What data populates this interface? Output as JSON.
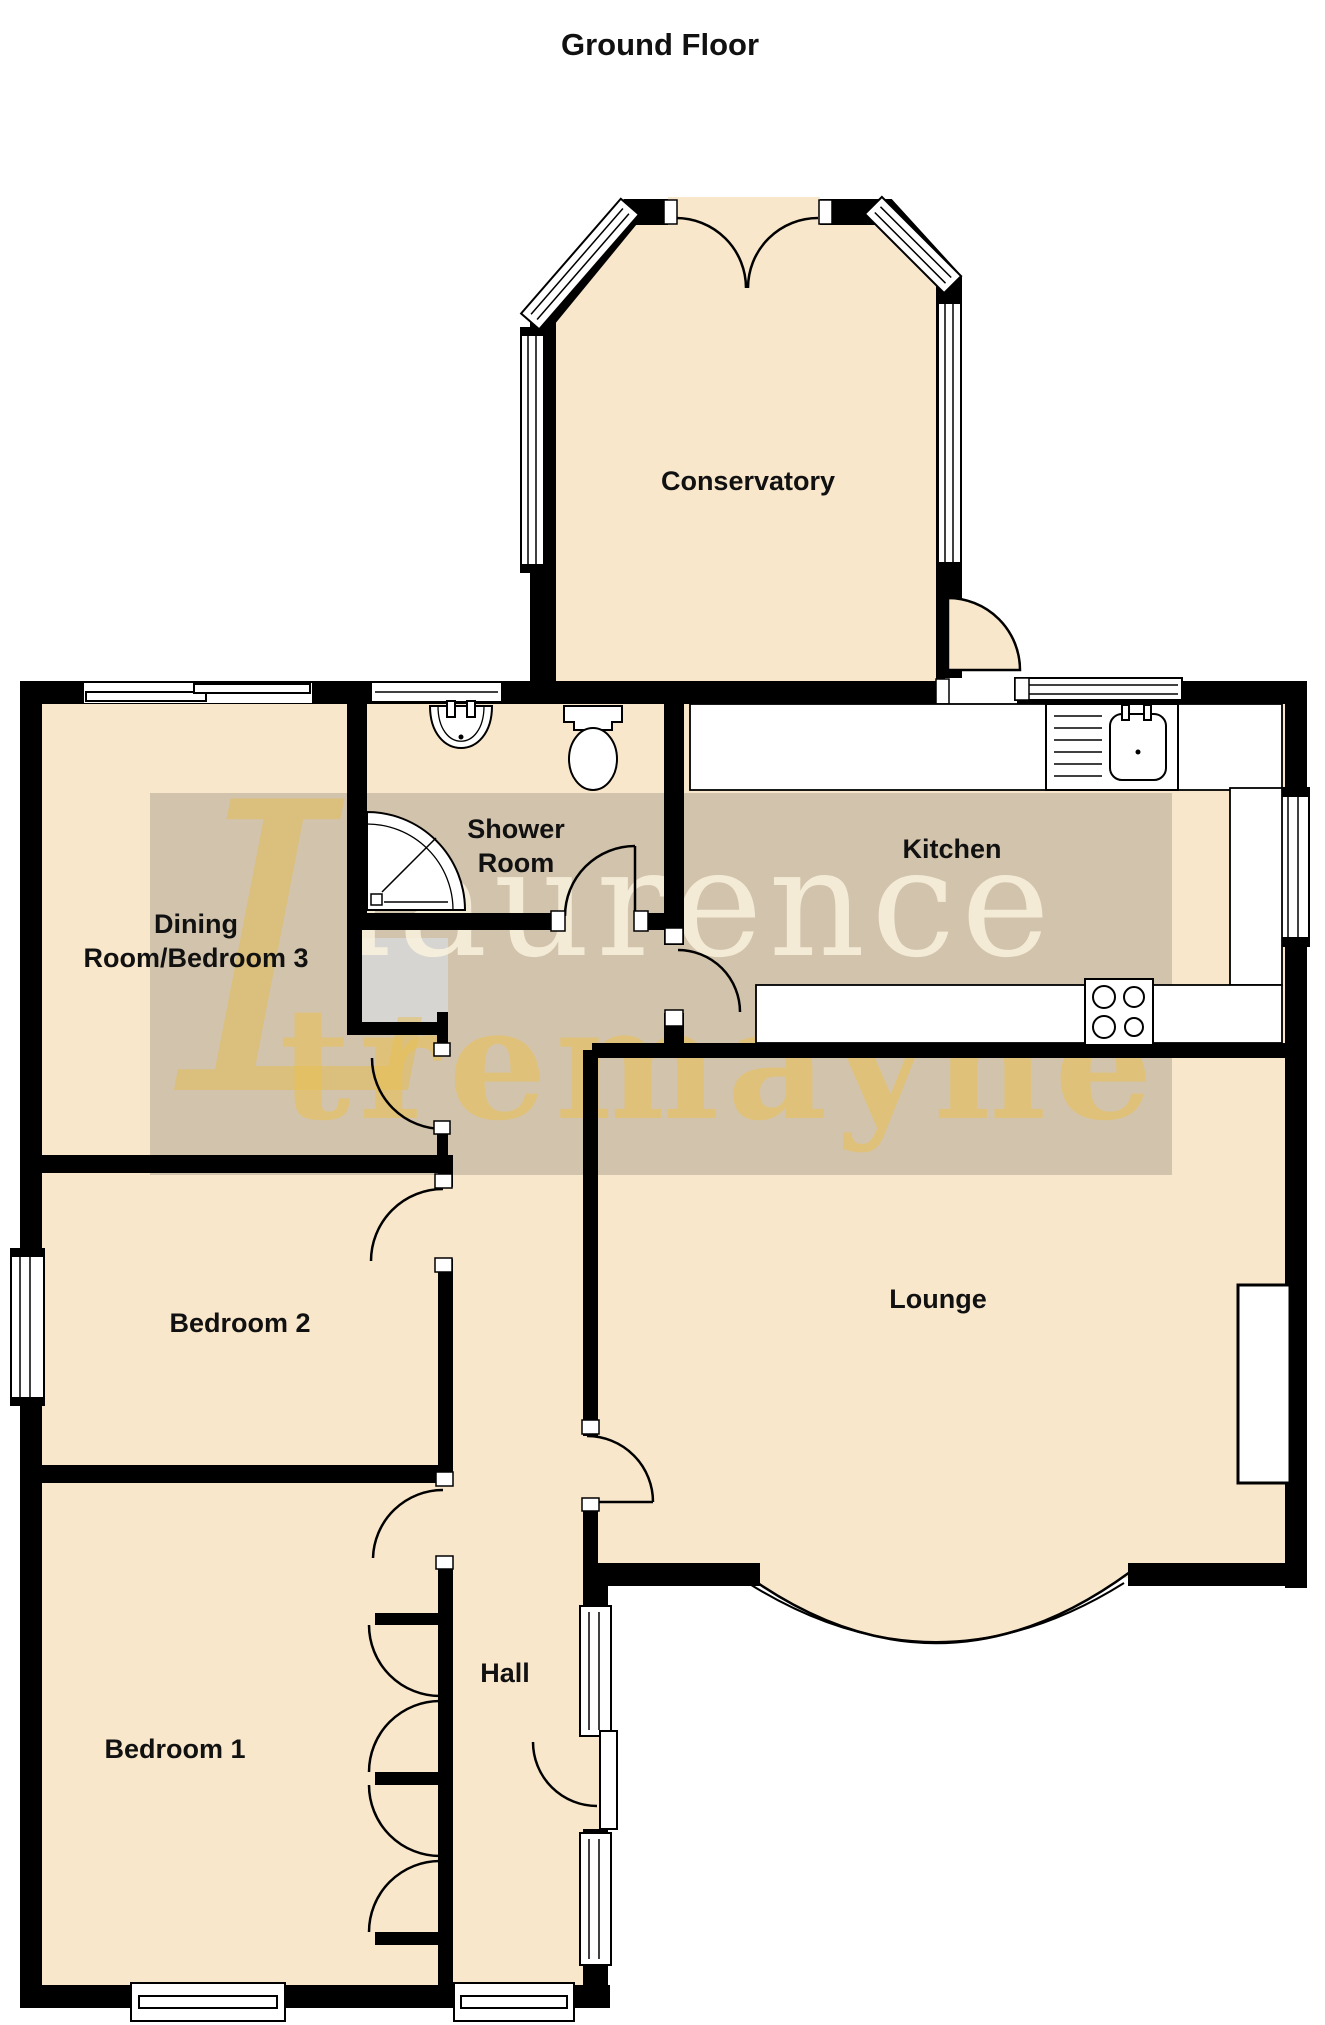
{
  "title": "Ground Floor",
  "rooms": {
    "conservatory": {
      "label": "Conservatory"
    },
    "shower": {
      "line1": "Shower",
      "line2": "Room"
    },
    "dining": {
      "line1": "Dining",
      "line2": "Room/Bedroom 3"
    },
    "kitchen": {
      "label": "Kitchen"
    },
    "lounge": {
      "label": "Lounge"
    },
    "bedroom2": {
      "label": "Bedroom 2"
    },
    "bedroom1": {
      "label": "Bedroom 1"
    },
    "hall": {
      "label": "Hall"
    }
  },
  "watermark": {
    "monogram": "L",
    "line1": "laurence",
    "line2": "tremayne"
  },
  "colors": {
    "floor": "#F9E7CC",
    "wall": "#000000",
    "watermark_band": "#6F685C",
    "watermark_pale": "#FBF3DE",
    "watermark_yellow": "#EBC14F",
    "label_ink": "#111111"
  },
  "fixtures": [
    "bathroom-sink",
    "toilet",
    "corner-shower",
    "kitchen-sink-drainer",
    "hob-4-burner",
    "fireplace",
    "kitchen-counters",
    "wardrobes"
  ]
}
